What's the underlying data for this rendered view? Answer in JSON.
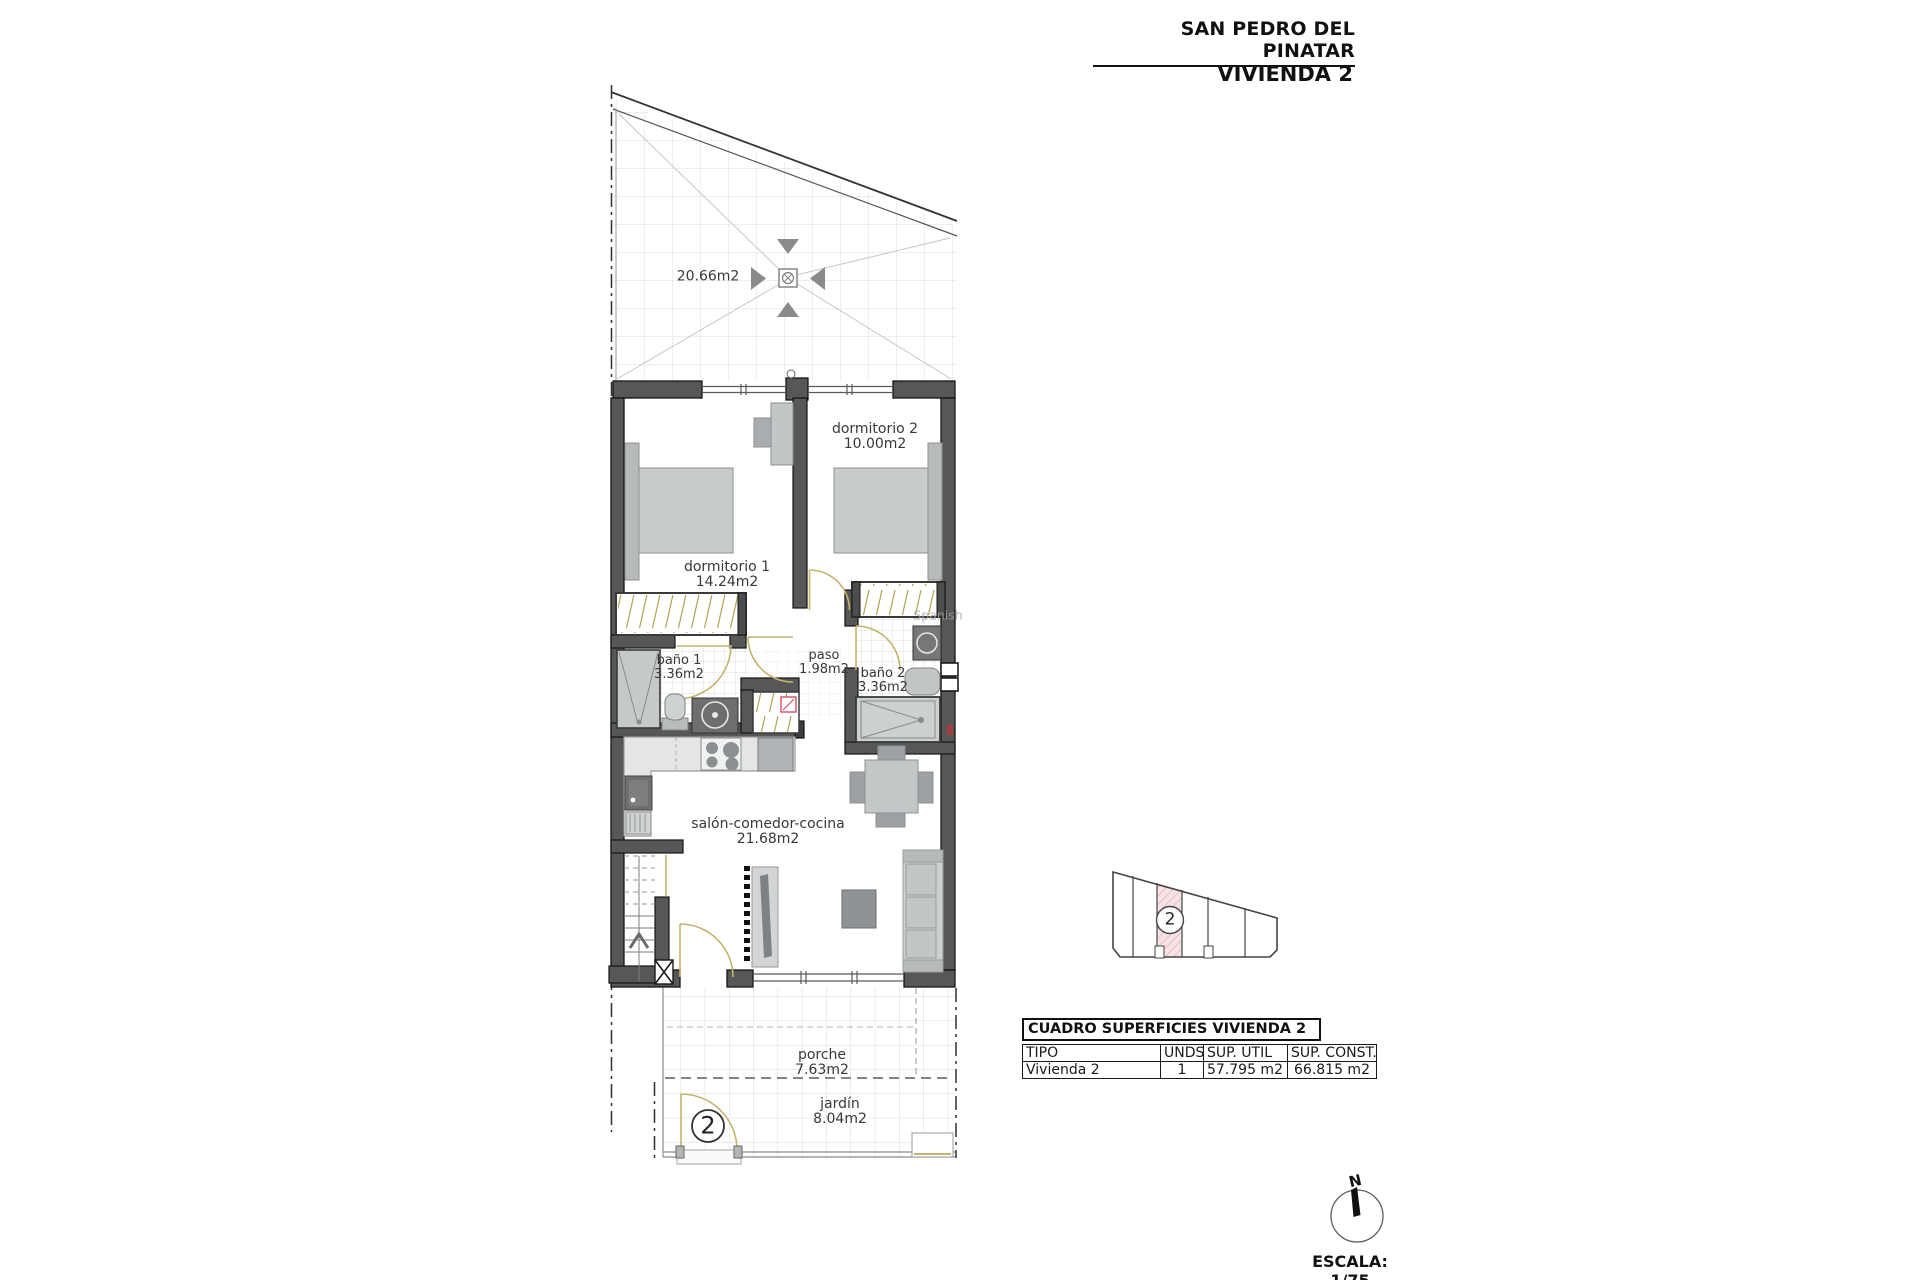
{
  "header": {
    "location_title": "SAN PEDRO DEL PINATAR",
    "unit_title": "VIVIENDA 2"
  },
  "plan": {
    "roof_terrace": {
      "area": "20.66m2"
    },
    "rooms": {
      "dormitorio2": {
        "name": "dormitorio 2",
        "area": "10.00m2"
      },
      "dormitorio1": {
        "name": "dormitorio 1",
        "area": "14.24m2"
      },
      "bano1": {
        "name": "baño 1",
        "area": "3.36m2"
      },
      "paso": {
        "name": "paso",
        "area": "1.98m2"
      },
      "bano2": {
        "name": "baño 2",
        "area": "3.36m2"
      },
      "salon": {
        "name": "salón-comedor-cocina",
        "area": "21.68m2"
      },
      "porche": {
        "name": "porche",
        "area": "7.63m2"
      },
      "jardin": {
        "name": "jardín",
        "area": "8.04m2"
      }
    },
    "entrance_marker": "2",
    "watermark": "Spanish"
  },
  "site_key": {
    "highlighted_unit": "2"
  },
  "surfaces_table": {
    "title": "CUADRO SUPERFICIES VIVIENDA 2",
    "columns": {
      "tipo": "TIPO",
      "unds": "UNDS.",
      "sup_util": "SUP. ÚTIL",
      "sup_const": "SUP. CONST."
    },
    "row": {
      "tipo": "Vivienda 2",
      "unds": "1",
      "sup_util": "57.795 m2",
      "sup_const": "66.815 m2"
    }
  },
  "compass": {
    "north": "N"
  },
  "scale_label": "ESCALA: 1/75",
  "colors": {
    "wall": "#575757",
    "wall_outline": "#151515",
    "furniture": "#c8cbcc",
    "furniture_dark": "#9aa0a2",
    "door": "#c5b36a",
    "wardrobe_hatch": "#b2a24e",
    "tile_line": "#dcdcdc",
    "site_highlight": "#f7e3e5",
    "marker_red": "#b03a3a"
  }
}
